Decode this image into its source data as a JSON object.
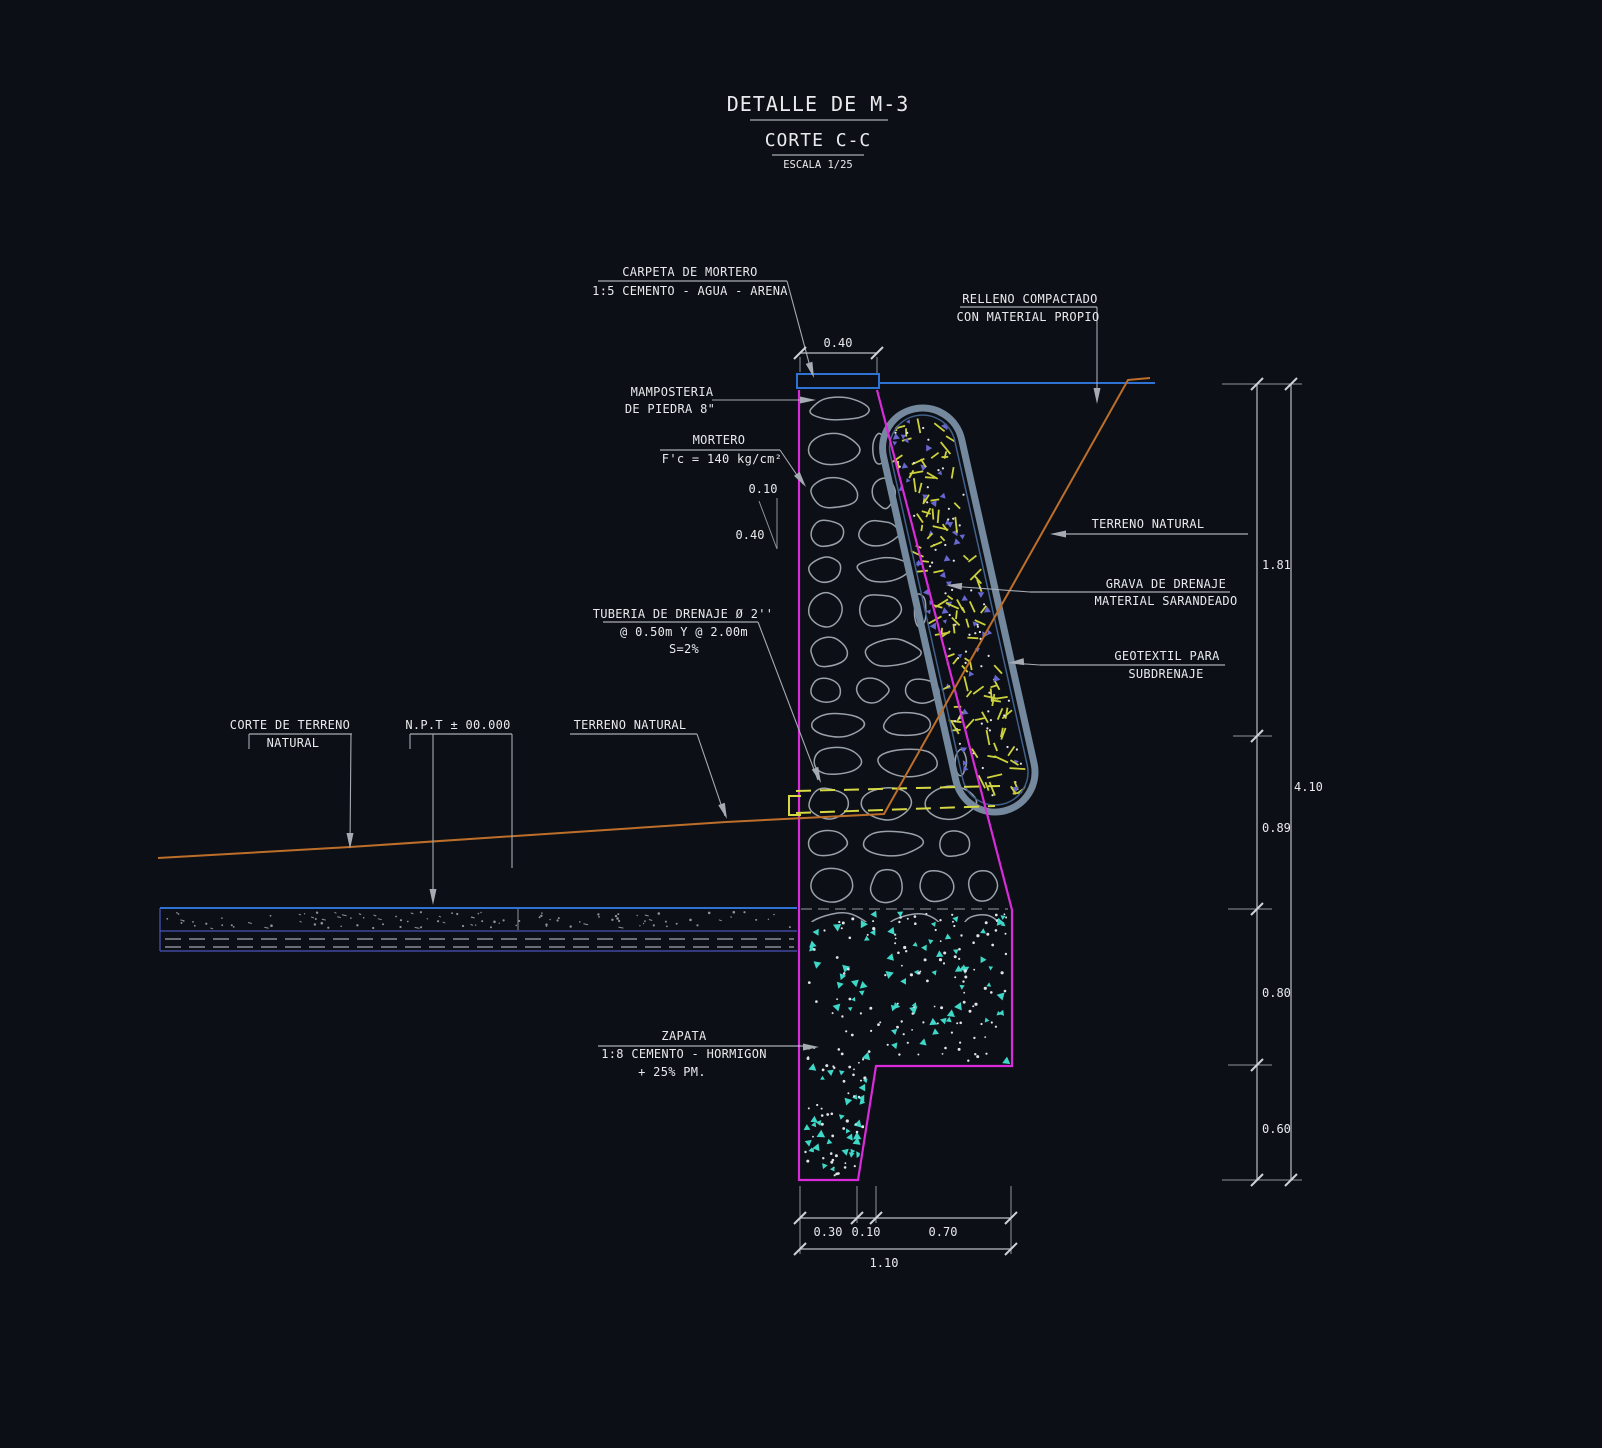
{
  "title": {
    "line1": "DETALLE DE M-3",
    "line2": "CORTE C-C",
    "scale": "ESCALA 1/25"
  },
  "labels": {
    "carpeta_l1": "CARPETA DE MORTERO",
    "carpeta_l2": "1:5 CEMENTO - AGUA - ARENA",
    "relleno_l1": "RELLENO COMPACTADO",
    "relleno_l2": "CON MATERIAL PROPIO",
    "mamposteria_l1": "MAMPOSTERIA",
    "mamposteria_l2": "DE PIEDRA 8\"",
    "mortero_l1": "MORTERO",
    "mortero_l2": "F'c = 140 kg/cm²",
    "terreno_right": "TERRENO NATURAL",
    "grava_l1": "GRAVA DE DRENAJE",
    "grava_l2": "MATERIAL SARANDEADO",
    "geotextil_l1": "GEOTEXTIL PARA",
    "geotextil_l2": "SUBDRENAJE",
    "tuberia_l1": "TUBERIA DE DRENAJE Ø 2''",
    "tuberia_l2": "@ 0.50m Y @ 2.00m",
    "tuberia_l3": "S=2%",
    "corte_l1": "CORTE DE TERRENO",
    "corte_l2": "NATURAL",
    "npt": "N.P.T ± 00.000",
    "terreno_mid": "TERRENO NATURAL",
    "zapata_l1": "ZAPATA",
    "zapata_l2": "1:8 CEMENTO - HORMIGON",
    "zapata_l3": "+ 25% PM."
  },
  "dimensions": {
    "top_width": "0.40",
    "batter_h": "0.10",
    "batter_v": "0.40",
    "right_1": "1.81",
    "right_2": "0.89",
    "right_3": "0.80",
    "right_4": "0.60",
    "right_total": "4.10",
    "bottom_1": "0.30",
    "bottom_2": "0.10",
    "bottom_3": "0.70",
    "bottom_total": "1.10"
  },
  "colors": {
    "background": "#0c0f15",
    "outline_magenta": "#d92bd9",
    "cad_blue": "#2e72d4",
    "terrain_orange": "#bd6f2a",
    "pipe_yellow": "#d6d943",
    "concrete_cyan": "#3ed8c8",
    "geotextile_steel": "#74899e",
    "stone_gray": "#9aa1aa",
    "text_white": "#e8eaed"
  }
}
